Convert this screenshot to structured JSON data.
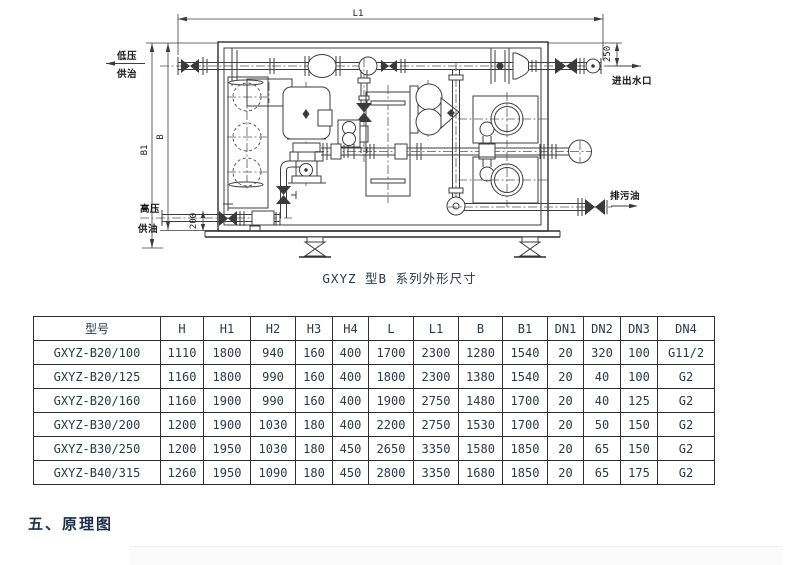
{
  "page": {
    "caption": "GXYZ 型B 系列外形尺寸",
    "section_title": "五、原理图"
  },
  "diagram": {
    "dims": {
      "l1": "L1",
      "b": "B",
      "b1": "B1",
      "d250": "250",
      "d200": "200"
    },
    "ports": {
      "low_pressure": "低压",
      "low_pressure_2": "供治",
      "high_pressure": "高压",
      "high_pressure_2": "供油",
      "water": "进出水口",
      "drain": "排污油"
    }
  },
  "table": {
    "headers": [
      "型号",
      "H",
      "H1",
      "H2",
      "H3",
      "H4",
      "L",
      "L1",
      "B",
      "B1",
      "DN1",
      "DN2",
      "DN3",
      "DN4"
    ],
    "rows": [
      [
        "GXYZ-B20/100",
        "1110",
        "1800",
        "940",
        "160",
        "400",
        "1700",
        "2300",
        "1280",
        "1540",
        "20",
        "320",
        "100",
        "G11/2"
      ],
      [
        "GXYZ-B20/125",
        "1160",
        "1800",
        "990",
        "160",
        "400",
        "1800",
        "2300",
        "1380",
        "1540",
        "20",
        "40",
        "100",
        "G2"
      ],
      [
        "GXYZ-B20/160",
        "1160",
        "1900",
        "990",
        "160",
        "400",
        "1900",
        "2750",
        "1480",
        "1700",
        "20",
        "40",
        "125",
        "G2"
      ],
      [
        "GXYZ-B30/200",
        "1200",
        "1900",
        "1030",
        "180",
        "400",
        "2200",
        "2750",
        "1530",
        "1700",
        "20",
        "50",
        "150",
        "G2"
      ],
      [
        "GXYZ-B30/250",
        "1200",
        "1950",
        "1030",
        "180",
        "450",
        "2650",
        "3350",
        "1580",
        "1850",
        "20",
        "65",
        "150",
        "G2"
      ],
      [
        "GXYZ-B40/315",
        "1260",
        "1950",
        "1090",
        "180",
        "450",
        "2800",
        "3350",
        "1680",
        "1850",
        "20",
        "65",
        "175",
        "G2"
      ]
    ]
  }
}
